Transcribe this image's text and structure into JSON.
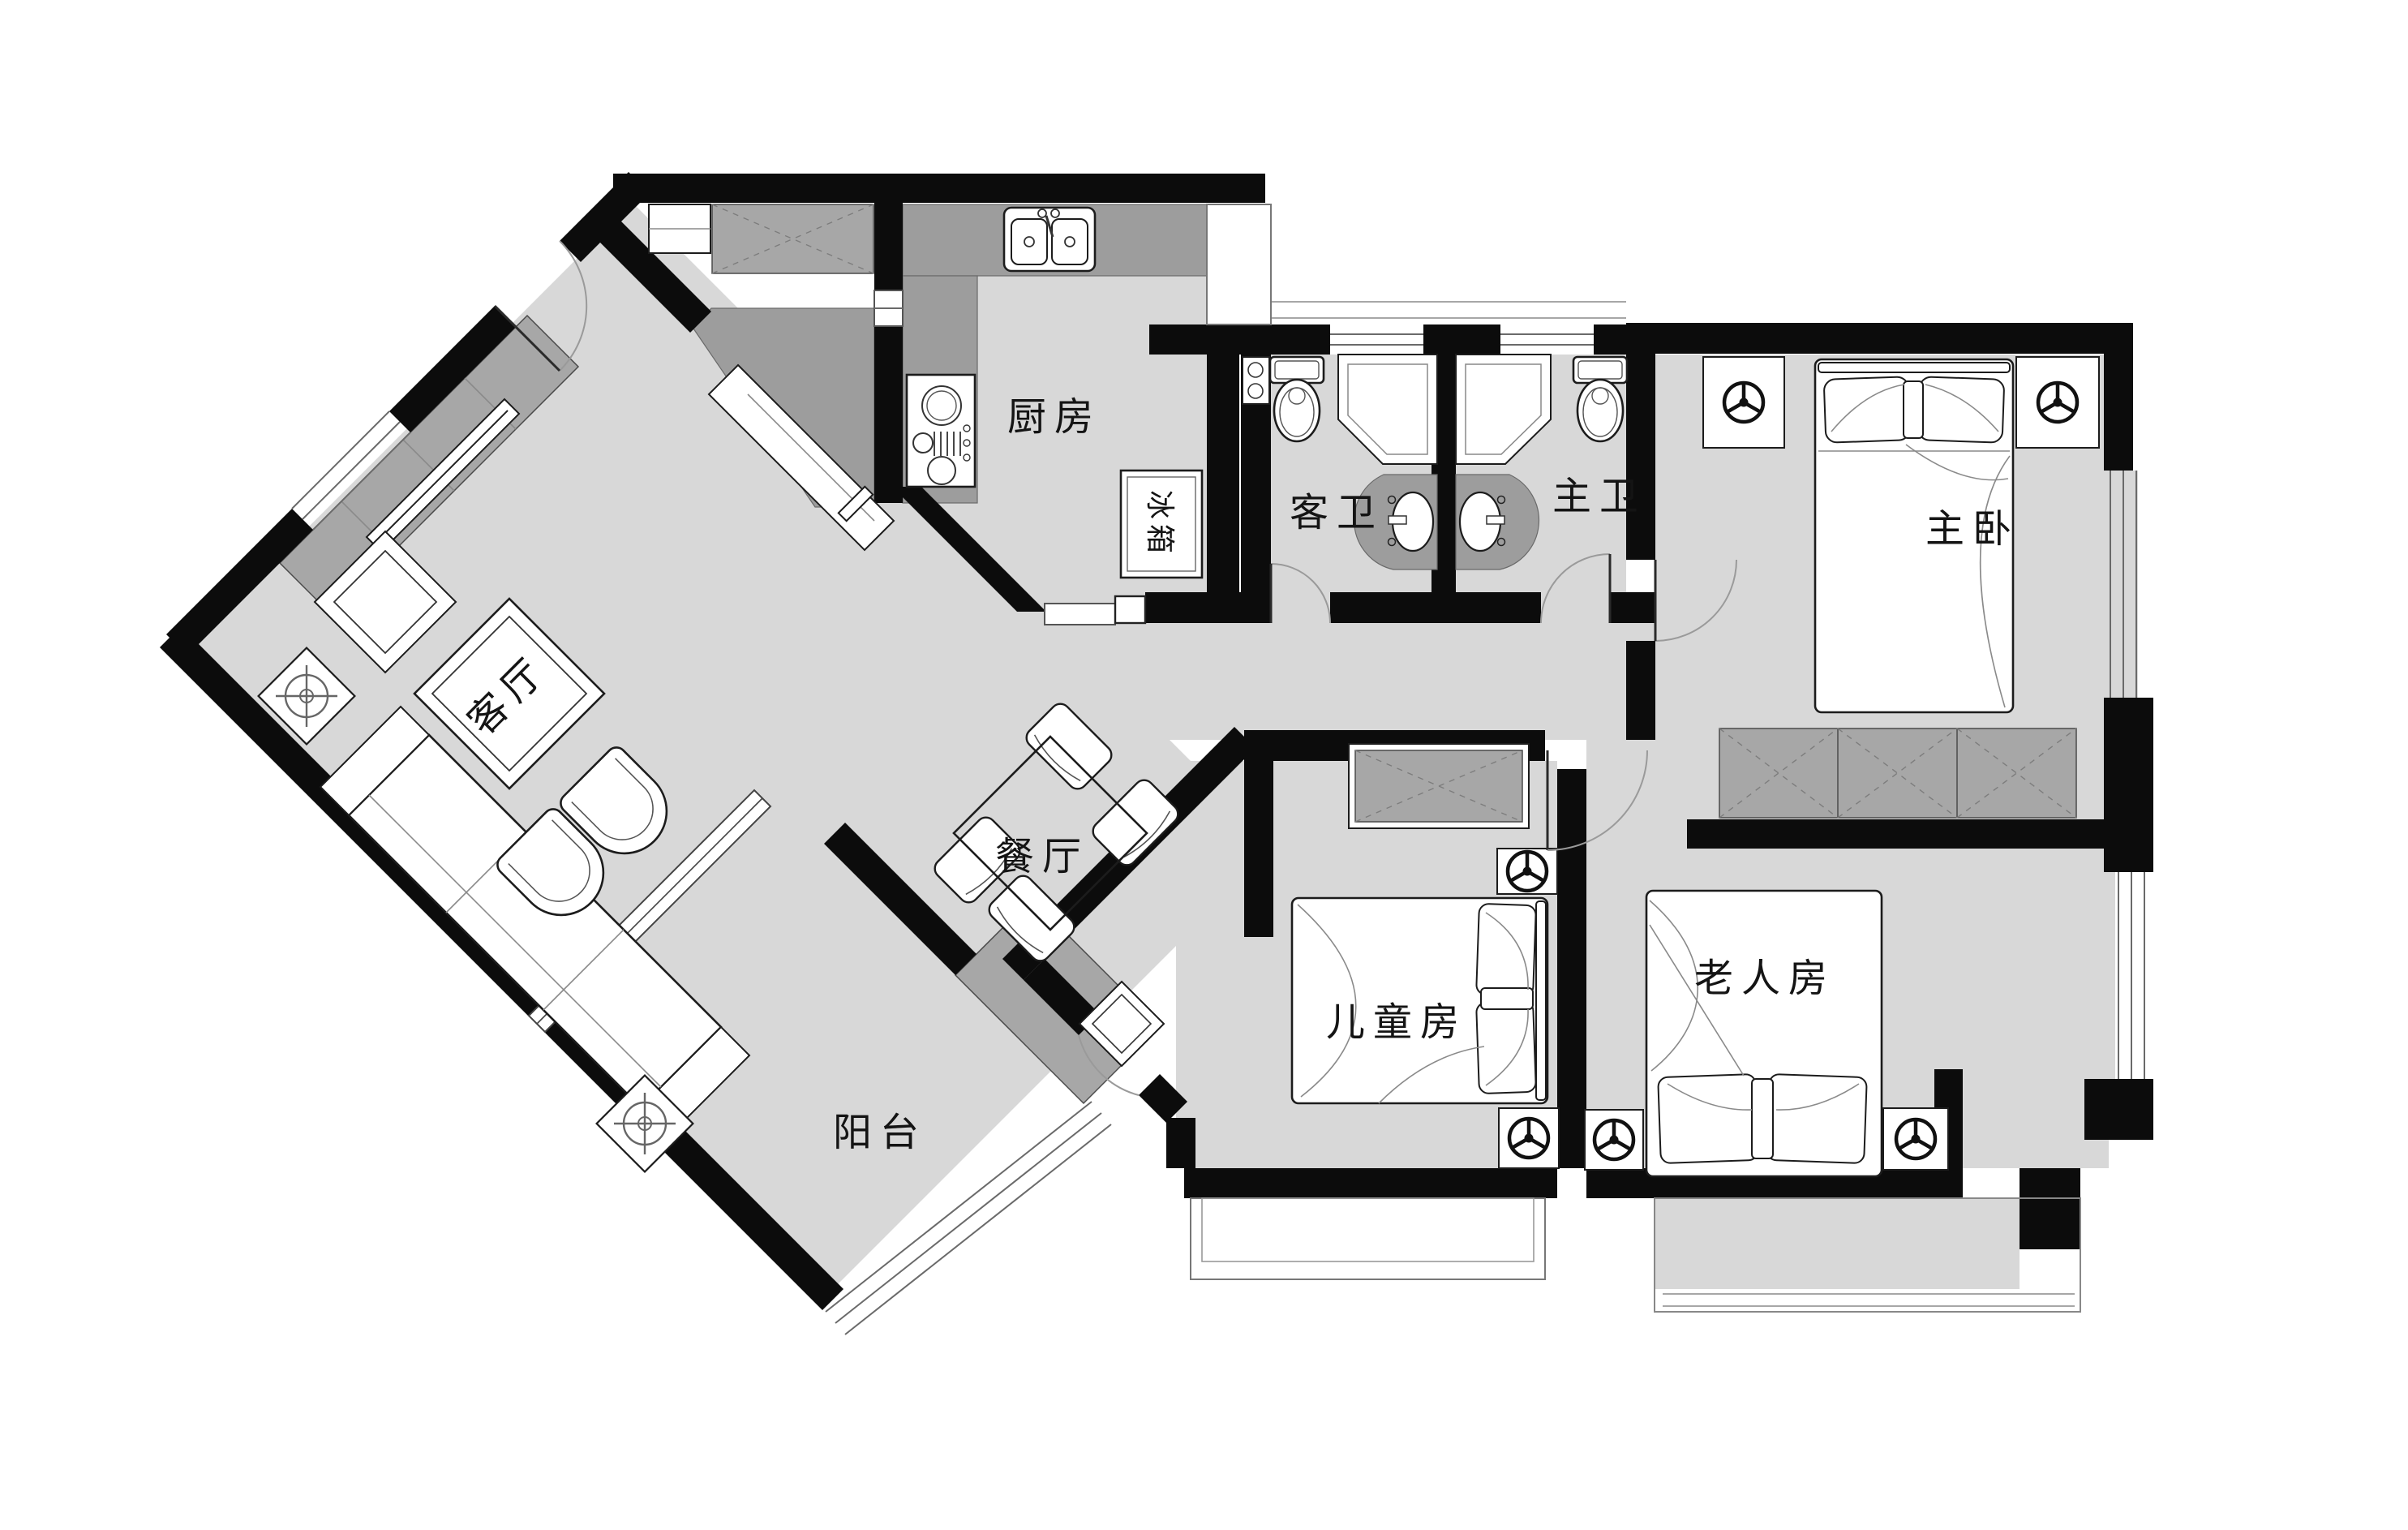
{
  "title": "三室两厅户型平面图",
  "colors": {
    "wall": "#0c0c0c",
    "floor": "#d8d8d8",
    "cabinet": "#a7a7a7",
    "counter": "#9d9d9d",
    "furniture_outline": "#1c1c1c",
    "thin_line": "#6a6a6a"
  },
  "rooms": {
    "kitchen": {
      "label": "厨房"
    },
    "guest_bathroom": {
      "label": "客卫"
    },
    "master_bathroom": {
      "label": "主卫"
    },
    "master_bedroom": {
      "label": "主卧"
    },
    "living_room": {
      "label": "客厅"
    },
    "dining_room": {
      "label": "餐厅"
    },
    "kids_room": {
      "label": "儿童房"
    },
    "elder_room": {
      "label": "老人房"
    },
    "balcony": {
      "label": "阳台"
    },
    "fridge": {
      "label": "冰箱"
    }
  },
  "icons": [
    "toilet-icon",
    "shower-icon",
    "basin-icon",
    "kitchen-sink-icon",
    "cooktop-icon",
    "refrigerator-icon",
    "double-bed-icon",
    "wardrobe-icon",
    "closet-icon",
    "sofa-icon",
    "coffee-table-icon",
    "tv-cabinet-icon",
    "side-table-icon",
    "dining-table-icon",
    "dining-chair-icon",
    "armchair-icon",
    "stool-icon",
    "bedside-lamp-icon",
    "floor-lamp-icon",
    "door-swing-icon",
    "sliding-door-icon",
    "window-icon",
    "bay-window-icon"
  ]
}
